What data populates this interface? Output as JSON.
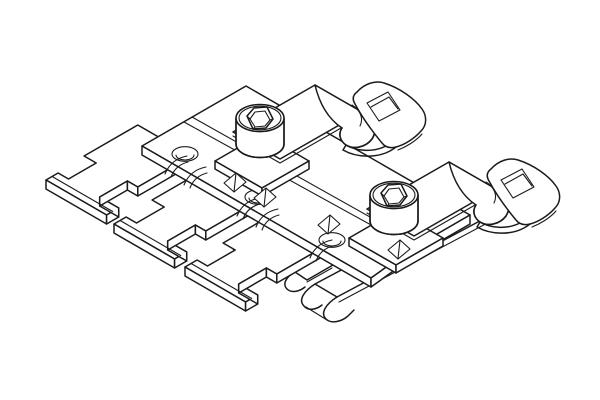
{
  "figure": {
    "description": "Monochrome isometric CAD line drawing of a DIN-rail adapter: stepped mounting plate with three countersunk holes, two socket-head cap screws on square pads, two folded sheet-metal spring clips with rounded slotted tabs, long leaf springs with curled hook ends, and three comb-style T-feet.",
    "style": "technical line art, no text"
  },
  "colors": {
    "background": "#ffffff",
    "line": "#1b1b1b",
    "fill": "#ffffff"
  },
  "parts": {
    "plate": "adapter-plate",
    "holes": [
      "mounting-hole-1",
      "mounting-hole-2",
      "mounting-hole-3"
    ],
    "screws": [
      "socket-screw-1",
      "socket-screw-2"
    ],
    "pads": [
      "screw-pad-1",
      "screw-pad-2"
    ],
    "clips": [
      "spring-clip-1",
      "spring-clip-2"
    ],
    "feet": [
      "comb-foot-1",
      "comb-foot-2",
      "comb-foot-3"
    ],
    "leaf_springs": [
      "leaf-spring-hook-a",
      "leaf-spring-hook-b",
      "leaf-spring-main"
    ]
  }
}
